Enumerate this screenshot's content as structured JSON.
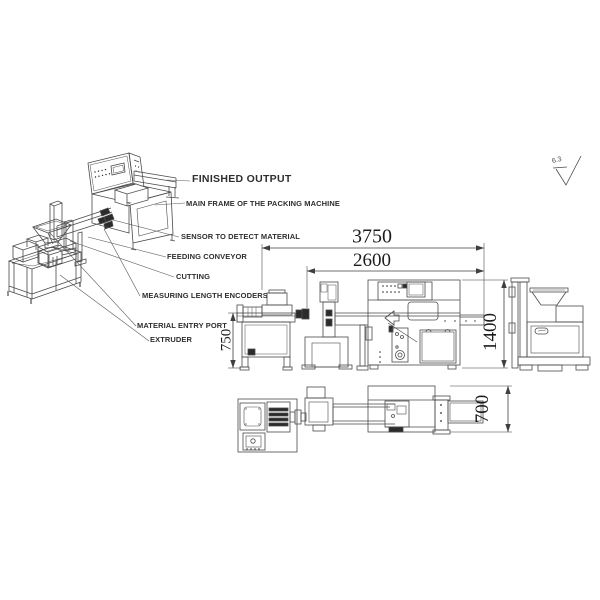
{
  "page": {
    "background": "#ffffff",
    "line_color": "#454545"
  },
  "iso_view": {
    "callouts": [
      {
        "id": "finished-output",
        "label": "FINISHED OUTPUT"
      },
      {
        "id": "main-frame",
        "label": "MAIN FRAME OF THE PACKING MACHINE"
      },
      {
        "id": "sensor",
        "label": "SENSOR TO DETECT MATERIAL"
      },
      {
        "id": "feeding-conveyor",
        "label": "FEEDING CONVEYOR"
      },
      {
        "id": "cutting",
        "label": "CUTTING"
      },
      {
        "id": "measuring-encoders",
        "label": "MEASURING LENGTH ENCODERS"
      },
      {
        "id": "material-entry",
        "label": "MATERIAL ENTRY PORT"
      },
      {
        "id": "extruder",
        "label": "EXTRUDER"
      }
    ]
  },
  "dimensions": {
    "overall_length_mm": "3750",
    "packing_machine_length_mm": "2600",
    "extruder_height_mm": "750",
    "machine_height_mm": "1400",
    "machine_width_mm": "700"
  },
  "surface_finish": {
    "roughness": "6.3"
  }
}
